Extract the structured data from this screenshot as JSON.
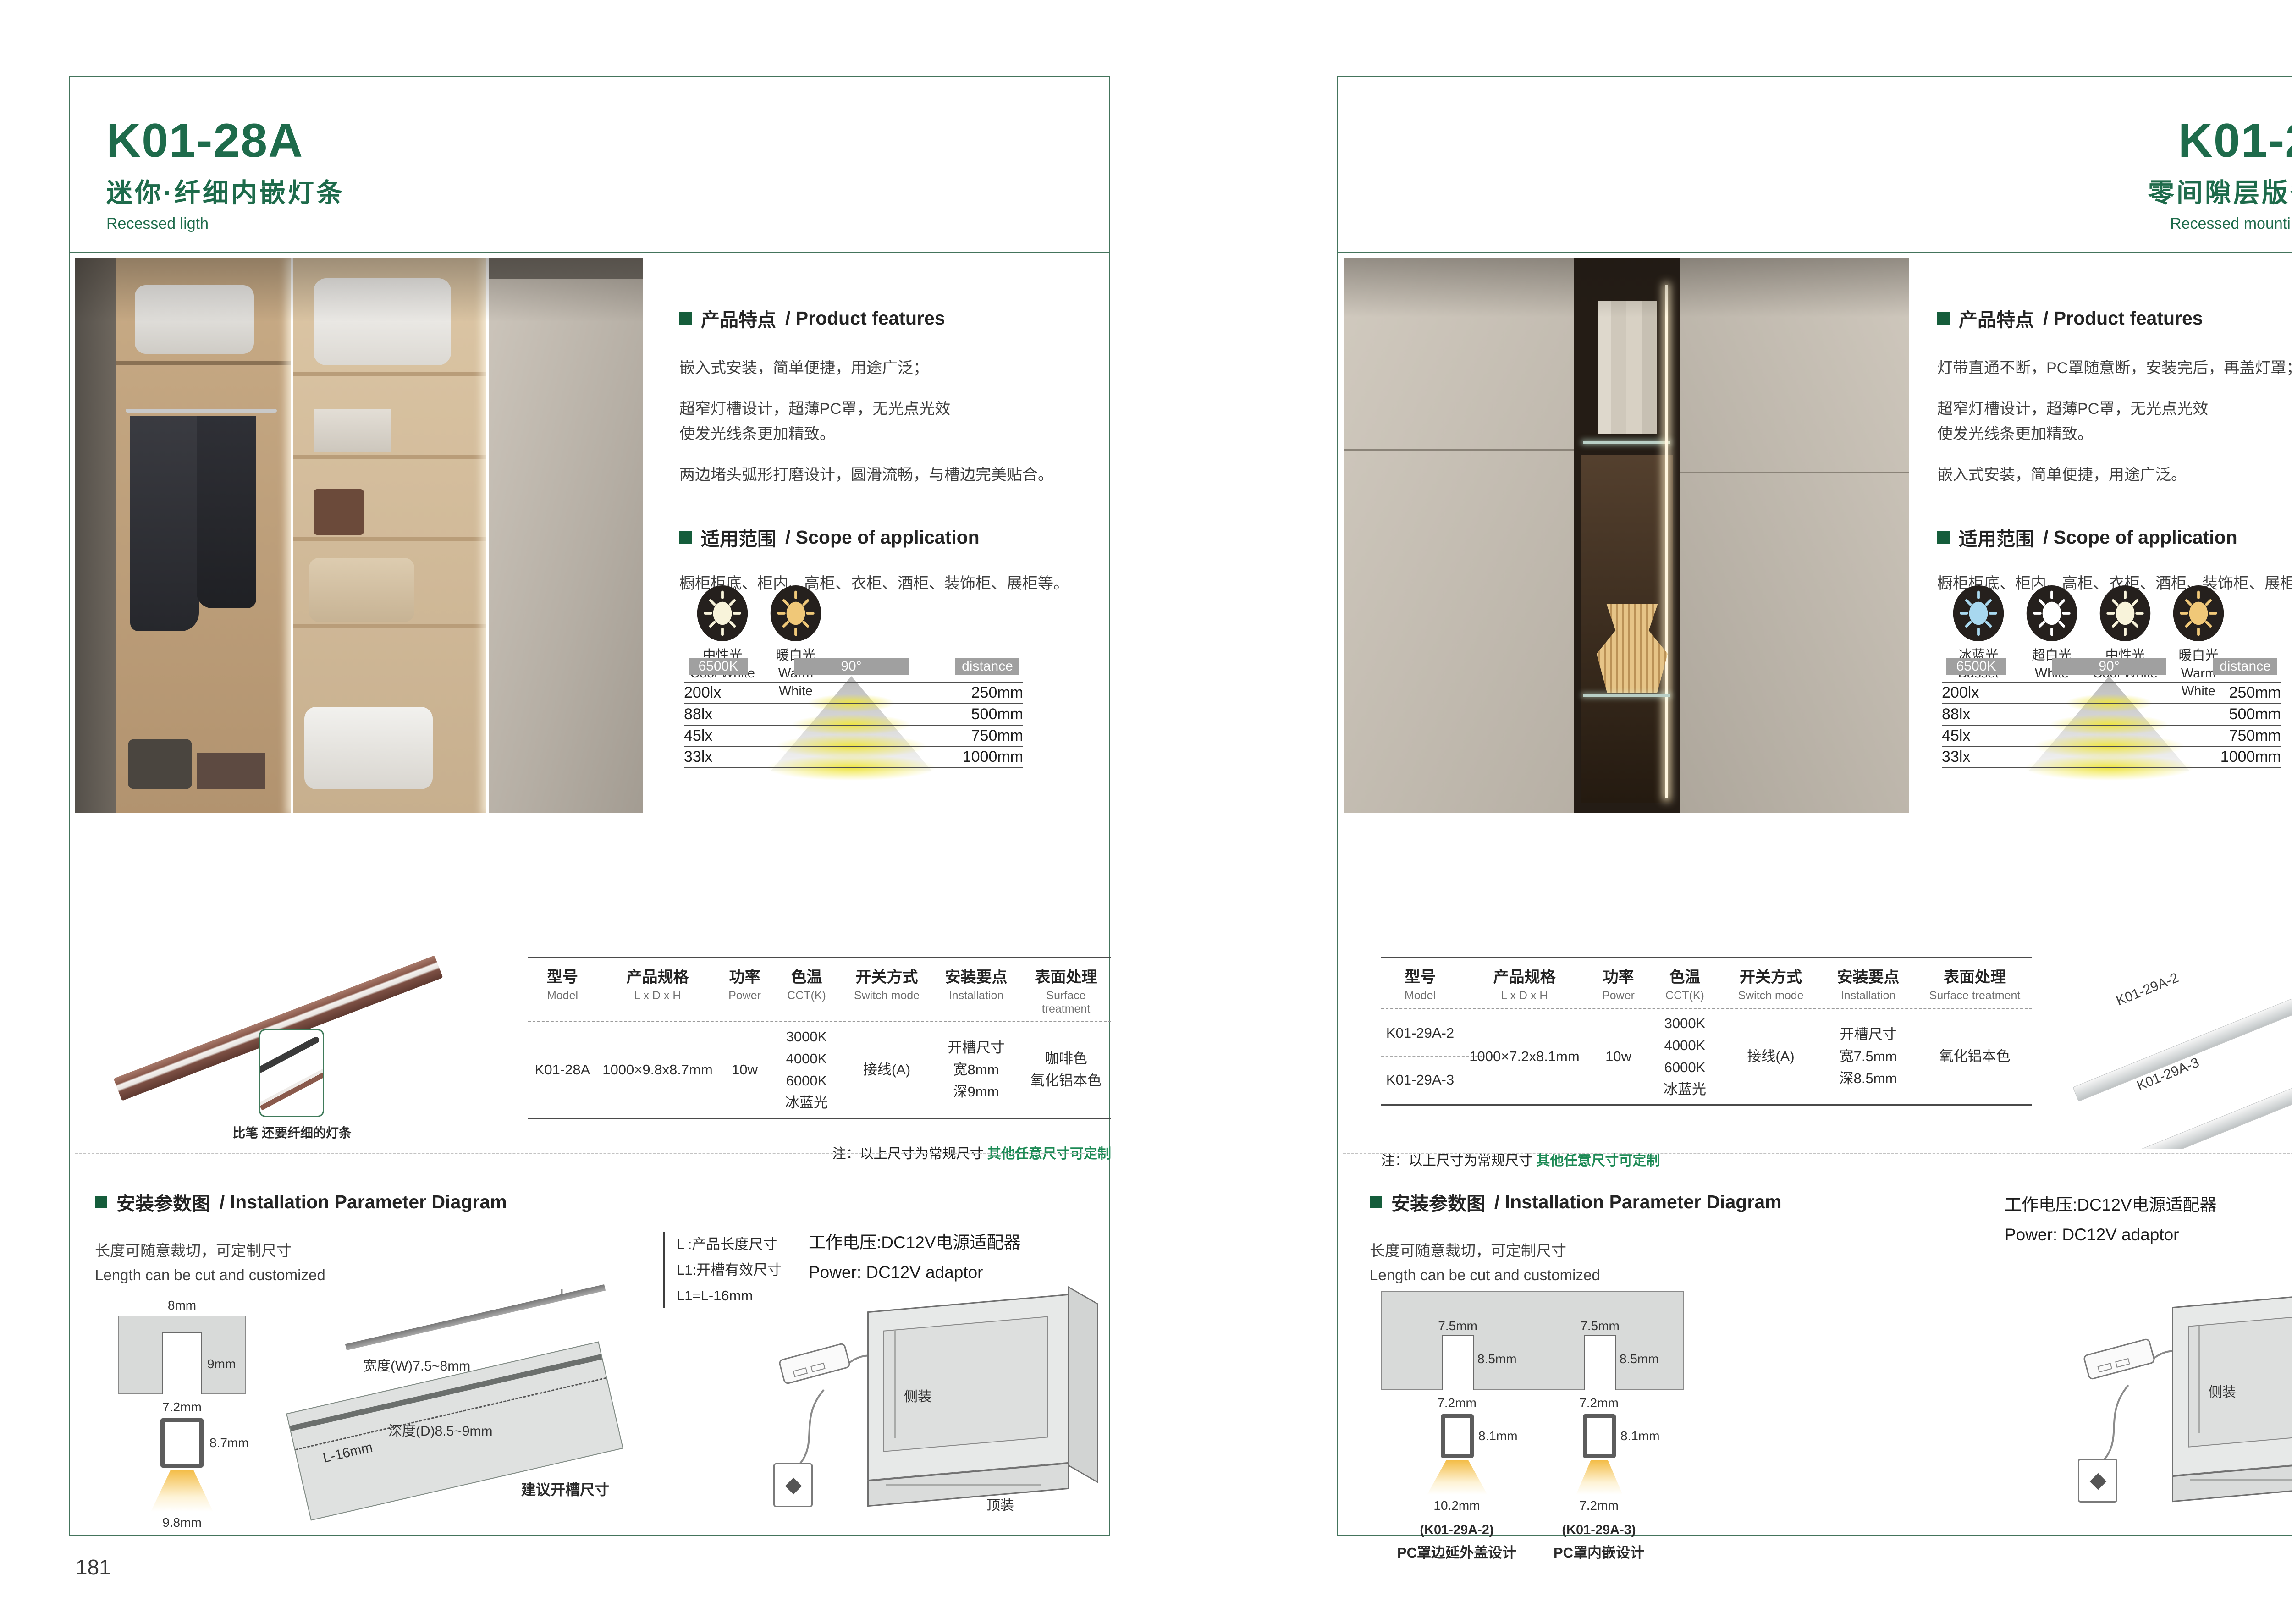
{
  "theme": {
    "green": "#1e6b4b",
    "frame": "#44745c",
    "note_green": "#1d8a55"
  },
  "page_left": {
    "page_number": "181",
    "header": {
      "model": "K01-28A",
      "subtitle_cn": "迷你·纤细内嵌灯条",
      "subtitle_en": "Recessed ligth"
    },
    "features": {
      "title_cn": "产品特点",
      "title_en": "/ Product features",
      "p1": "嵌入式安装，简单便捷，用途广泛；",
      "p2a": "超窄灯槽设计，超薄PC罩，无光点光效",
      "p2b": "使发光线条更加精致。",
      "p3": "两边堵头弧形打磨设计，圆滑流畅，与槽边完美贴合。"
    },
    "scope": {
      "title_cn": "适用范围",
      "title_en": "/ Scope of application",
      "text": "橱柜柜底、柜内、高柜、衣柜、酒柜、装饰柜、展柜等。"
    },
    "light_icons": [
      {
        "label_cn": "中性光",
        "label_en": "Cool White",
        "color": "#f8f3da"
      },
      {
        "label_cn": "暖白光",
        "label_en": "Warm White",
        "color": "#f0c878"
      }
    ],
    "beam_chart": {
      "cct": "6500K",
      "angle": "90°",
      "distance": "distance",
      "rows": [
        {
          "lx": "200lx",
          "mm": "250mm"
        },
        {
          "lx": "88lx",
          "mm": "500mm"
        },
        {
          "lx": "45lx",
          "mm": "750mm"
        },
        {
          "lx": "33lx",
          "mm": "1000mm"
        }
      ]
    },
    "product_caption": "比笔 还要纤细的灯条",
    "table": {
      "headers": [
        {
          "cn": "型号",
          "en": "Model"
        },
        {
          "cn": "产品规格",
          "en": "L x D x H"
        },
        {
          "cn": "功率",
          "en": "Power"
        },
        {
          "cn": "色温",
          "en": "CCT(K)"
        },
        {
          "cn": "开关方式",
          "en": "Switch mode"
        },
        {
          "cn": "安装要点",
          "en": "Installation"
        },
        {
          "cn": "表面处理",
          "en": "Surface treatment"
        }
      ],
      "row": {
        "model": "K01-28A",
        "spec": "1000×9.8x8.7mm",
        "power": "10w",
        "cct": [
          "3000K",
          "4000K",
          "6000K",
          "冰蓝光"
        ],
        "switch": "接线(A)",
        "install": [
          "开槽尺寸",
          "宽8mm",
          "深9mm"
        ],
        "surface": [
          "咖啡色",
          "氧化铝本色"
        ]
      }
    },
    "note": {
      "label": "注：以上尺寸为常规尺寸 ",
      "highlight": "其他任意尺寸可定制"
    },
    "install": {
      "title_cn": "安装参数图",
      "title_en": "/ Installation Parameter Diagram",
      "length_cn": "长度可随意裁切，可定制尺寸",
      "length_en": "Length can be cut and customized",
      "legend": [
        "L  :产品长度尺寸",
        "L1:开槽有效尺寸",
        "L1=L-16mm"
      ],
      "power_cn": "工作电压:DC12V电源适配器",
      "power_en": "Power: DC12V adaptor",
      "cross_section": {
        "top_width": "8mm",
        "depth": "9mm",
        "inner_width": "7.2mm",
        "height": "8.7mm",
        "beam_width": "9.8mm"
      },
      "slot3d": {
        "width": "宽度(W)7.5~8mm",
        "depth": "深度(D)8.5~9mm",
        "l_minus": "L-16mm",
        "l": "L",
        "caption": "建议开槽尺寸"
      },
      "cabinet": {
        "side": "侧装",
        "top": "顶装"
      }
    }
  },
  "page_right": {
    "page_number": "182",
    "header": {
      "model": "K01-29A",
      "subtitle_cn": "零间隙层版条形灯",
      "subtitle_en": "Recessed mounting LED light"
    },
    "features": {
      "title_cn": "产品特点",
      "title_en": "/ Product features",
      "p1": "灯带直通不断，PC罩随意断，安装完后，再盖灯罩；",
      "p2a": "超窄灯槽设计，超薄PC罩，无光点光效",
      "p2b": "使发光线条更加精致。",
      "p3": "嵌入式安装，简单便捷，用途广泛。"
    },
    "scope": {
      "title_cn": "适用范围",
      "title_en": "/ Scope of application",
      "text": "橱柜柜底、柜内、高柜、衣柜、酒柜、装饰柜、展柜等。"
    },
    "light_icons": [
      {
        "label_cn": "冰蓝光",
        "label_en": "Basset",
        "color": "#a8d8ef"
      },
      {
        "label_cn": "超白光",
        "label_en": "White",
        "color": "#ffffff"
      },
      {
        "label_cn": "中性光",
        "label_en": "Cool White",
        "color": "#f8f3da"
      },
      {
        "label_cn": "暖白光",
        "label_en": "Warm White",
        "color": "#f0c878"
      }
    ],
    "beam_chart": {
      "cct": "6500K",
      "angle": "90°",
      "distance": "distance",
      "rows": [
        {
          "lx": "200lx",
          "mm": "250mm"
        },
        {
          "lx": "88lx",
          "mm": "500mm"
        },
        {
          "lx": "45lx",
          "mm": "750mm"
        },
        {
          "lx": "33lx",
          "mm": "1000mm"
        }
      ]
    },
    "strip_labels": [
      "K01-29A-2",
      "K01-29A-3"
    ],
    "table": {
      "headers": [
        {
          "cn": "型号",
          "en": "Model"
        },
        {
          "cn": "产品规格",
          "en": "L x D x H"
        },
        {
          "cn": "功率",
          "en": "Power"
        },
        {
          "cn": "色温",
          "en": "CCT(K)"
        },
        {
          "cn": "开关方式",
          "en": "Switch mode"
        },
        {
          "cn": "安装要点",
          "en": "Installation"
        },
        {
          "cn": "表面处理",
          "en": "Surface treatment"
        }
      ],
      "row": {
        "models": [
          "K01-29A-2",
          "K01-29A-3"
        ],
        "spec": "1000×7.2x8.1mm",
        "power": "10w",
        "cct": [
          "3000K",
          "4000K",
          "6000K",
          "冰蓝光"
        ],
        "switch": "接线(A)",
        "install": [
          "开槽尺寸",
          "宽7.5mm",
          "深8.5mm"
        ],
        "surface": [
          "氧化铝本色"
        ]
      }
    },
    "note": {
      "label": "注：以上尺寸为常规尺寸 ",
      "highlight": "其他任意尺寸可定制"
    },
    "install": {
      "title_cn": "安装参数图",
      "title_en": "/ Installation Parameter Diagram",
      "length_cn": "长度可随意裁切，可定制尺寸",
      "length_en": "Length can be cut and customized",
      "power_cn": "工作电压:DC12V电源适配器",
      "power_en": "Power: DC12V adaptor",
      "slots": [
        {
          "top_width": "7.5mm",
          "depth": "8.5mm",
          "inner_width": "7.2mm",
          "height": "8.1mm",
          "beam_width": "10.2mm",
          "model": "(K01-29A-2)",
          "caption": "PC罩边延外盖设计"
        },
        {
          "top_width": "7.5mm",
          "depth": "8.5mm",
          "inner_width": "7.2mm",
          "height": "8.1mm",
          "beam_width": "7.2mm",
          "model": "(K01-29A-3)",
          "caption": "PC罩内嵌设计"
        }
      ],
      "cabinet": {
        "side": "侧装",
        "top": "顶装"
      }
    }
  }
}
